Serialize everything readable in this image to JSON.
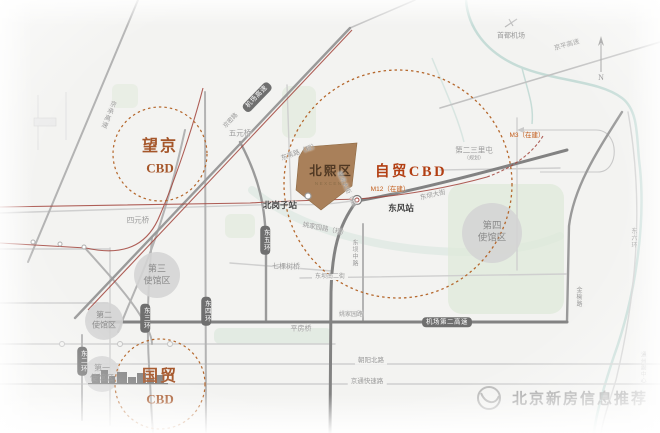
{
  "map": {
    "accent_color": "#b5672c",
    "cbd": {
      "wangjing": {
        "line1": "望京",
        "line2": "CBD"
      },
      "guomao": {
        "line1": "国贸",
        "line2": "CBD"
      },
      "zimao": "自贸CBD"
    },
    "project": {
      "name": "北熙区",
      "subtitle": "NEXCENE"
    },
    "stations": {
      "dongfeng": "东风站",
      "beigangzi": "北岗子站"
    },
    "metro": {
      "m12": "M12（在建）",
      "m3": "M3（在建）"
    },
    "embassy": {
      "fourth": {
        "line1": "第四",
        "line2": "使馆区"
      },
      "third": {
        "line1": "第三",
        "line2": "使馆区"
      },
      "second": {
        "line1": "第二",
        "line2": "使馆区"
      },
      "first": {
        "line1": "第一",
        "line2": "使馆区"
      }
    },
    "bridges": {
      "wuyuan": "五元桥",
      "siyuan": "四元桥",
      "qikeshu": "七棵树桥",
      "pingfang": "平房桥"
    },
    "roads": {
      "jichang_gaosu": "机场高速",
      "jicheng_gaosu": "京承高速",
      "jingmi_lu": "京密路",
      "jingping_gaosu": "京平高速",
      "dongwei_lu": "东苇路（规）",
      "yaojiayuan_gui": "姚家园路（规）",
      "tuofang_dajie": "驼房大街（规）",
      "dongba_dajie": "东坝大街",
      "dongba_zhonglu": "东坝中路",
      "dongba_nanerjie": "东坝南二街",
      "yaojiayuan_lu": "姚家园路",
      "jichang_dier_gaosu": "机场第二高速",
      "dong_er_huan": "东二环",
      "dong_san_huan": "东三环",
      "dong_si_huan": "东四环",
      "dong_wu_huan": "东五环",
      "dong_liu_huan": "东六环",
      "jinyu_lu": "金榆路",
      "chaoyang_beilu": "朝阳北路",
      "jingtong_kuaisulu": "京通快速路"
    },
    "places": {
      "airport": "首都机场",
      "second_sanlitun": "第二三里屯",
      "second_sanlitun_note": "（规划）",
      "tongzhou": "通州副中心"
    },
    "compass": {
      "north": "N"
    },
    "watermark": {
      "text": "北京新房信息推荐"
    }
  }
}
